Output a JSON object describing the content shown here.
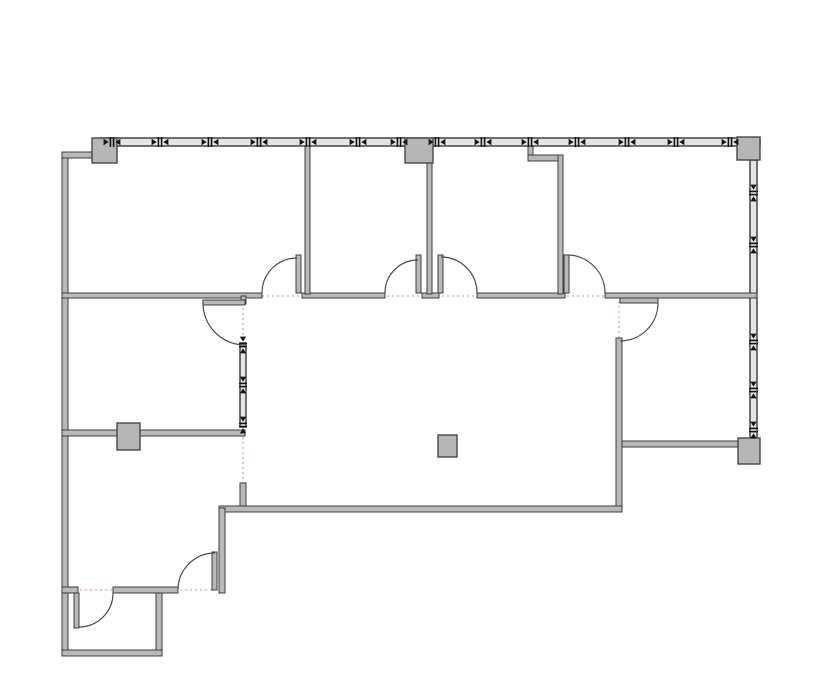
{
  "meta": {
    "title": "office-suite-floor-plan",
    "canvas_width": 835,
    "canvas_height": 678,
    "background": "#ffffff"
  },
  "style": {
    "wall_fill": "#b9b9b9",
    "wall_stroke": "#3d3d3d",
    "window_fill": "#e4e4e4",
    "window_stroke": "#383838",
    "column_fill": "#b6b6b6",
    "column_stroke": "#474747",
    "door_arc_color": "#4a4a4a",
    "opening_dot_color": "#dcc6d8",
    "mullion_color": "#161616"
  },
  "plan": {
    "openings": [
      {
        "name": "opening-line-corridor",
        "x1": 62,
        "y1": 296,
        "x2": 757,
        "y2": 296
      },
      {
        "name": "opening-line-lobby-west-door",
        "x1": 243,
        "y1": 298,
        "x2": 243,
        "y2": 345
      },
      {
        "name": "opening-line-lobby-southwest",
        "x1": 243,
        "y1": 427,
        "x2": 243,
        "y2": 483
      },
      {
        "name": "opening-line-southeast-room-door",
        "x1": 619,
        "y1": 296,
        "x2": 619,
        "y2": 340
      },
      {
        "name": "opening-line-southwest-rooms",
        "x1": 70,
        "y1": 590,
        "x2": 215,
        "y2": 590
      }
    ],
    "window_walls": [
      {
        "name": "north-window-wall",
        "x": 100,
        "y": 138,
        "w": 660,
        "h": 8,
        "orient": "h",
        "mullions": [
          112,
          160,
          210,
          259,
          308,
          358,
          399,
          437,
          483,
          530,
          577,
          627,
          676,
          730
        ]
      },
      {
        "name": "east-window-wall",
        "x": 750,
        "y": 160,
        "w": 7,
        "h": 278,
        "orient": "v",
        "mullions": [
          193,
          245,
          342,
          390,
          430
        ]
      },
      {
        "name": "lobby-glazed-partition",
        "x": 240,
        "y": 343,
        "w": 6,
        "h": 84,
        "orient": "v",
        "mullions": [
          345,
          385,
          425
        ]
      }
    ],
    "walls": [
      {
        "name": "west-exterior-wall",
        "x": 62,
        "y": 152,
        "w": 6,
        "h": 504
      },
      {
        "name": "northwest-wall-stub",
        "x": 62,
        "y": 152,
        "w": 30,
        "h": 6
      },
      {
        "name": "corridor-wall-seg-1",
        "x": 62,
        "y": 293,
        "w": 200,
        "h": 5
      },
      {
        "name": "corridor-wall-seg-2",
        "x": 302,
        "y": 293,
        "w": 83,
        "h": 5
      },
      {
        "name": "corridor-wall-seg-3",
        "x": 422,
        "y": 293,
        "w": 17,
        "h": 5
      },
      {
        "name": "corridor-wall-seg-4",
        "x": 477,
        "y": 293,
        "w": 88,
        "h": 5
      },
      {
        "name": "corridor-wall-seg-5",
        "x": 605,
        "y": 293,
        "w": 152,
        "h": 5
      },
      {
        "name": "divider-office1-office2",
        "x": 305,
        "y": 146,
        "w": 5,
        "h": 148
      },
      {
        "name": "divider-office2-office3",
        "x": 427,
        "y": 158,
        "w": 5,
        "h": 136
      },
      {
        "name": "office3-jog-stub",
        "x": 528,
        "y": 146,
        "w": 5,
        "h": 12
      },
      {
        "name": "office3-jog-wall",
        "x": 528,
        "y": 155,
        "w": 35,
        "h": 6
      },
      {
        "name": "divider-office3-office4",
        "x": 558,
        "y": 155,
        "w": 5,
        "h": 139
      },
      {
        "name": "lobby-east-wall",
        "x": 616,
        "y": 338,
        "w": 6,
        "h": 170
      },
      {
        "name": "lobby-west-wall-lower",
        "x": 240,
        "y": 483,
        "w": 6,
        "h": 25
      },
      {
        "name": "west-midroom-south-wall",
        "x": 62,
        "y": 430,
        "w": 183,
        "h": 6
      },
      {
        "name": "lobby-south-wall",
        "x": 219,
        "y": 506,
        "w": 403,
        "h": 6
      },
      {
        "name": "southeast-room-south-wall",
        "x": 622,
        "y": 441,
        "w": 120,
        "h": 6
      },
      {
        "name": "southwest-room-east-wall",
        "x": 219,
        "y": 508,
        "w": 6,
        "h": 85
      },
      {
        "name": "southwest-wall-stub",
        "x": 62,
        "y": 587,
        "w": 16,
        "h": 6
      },
      {
        "name": "southwest-room-south-wall-seg",
        "x": 113,
        "y": 587,
        "w": 65,
        "h": 6
      },
      {
        "name": "entry-room-east-wall",
        "x": 156,
        "y": 593,
        "w": 6,
        "h": 57
      },
      {
        "name": "entry-room-south-wall",
        "x": 62,
        "y": 650,
        "w": 100,
        "h": 6
      },
      {
        "name": "lobby-west-door-jamb",
        "x": 241,
        "y": 296,
        "w": 5,
        "h": 8
      }
    ],
    "door_leaves": [
      {
        "name": "office1-door-leaf",
        "x": 296,
        "y": 255,
        "w": 5,
        "h": 38
      },
      {
        "name": "office2-door-leaf",
        "x": 416,
        "y": 255,
        "w": 5,
        "h": 38
      },
      {
        "name": "office3-door-leaf",
        "x": 438,
        "y": 255,
        "w": 5,
        "h": 38
      },
      {
        "name": "office4-door-leaf",
        "x": 564,
        "y": 255,
        "w": 5,
        "h": 38
      },
      {
        "name": "west-midroom-door-leaf",
        "x": 203,
        "y": 300,
        "w": 42,
        "h": 5
      },
      {
        "name": "southeast-room-door-leaf",
        "x": 620,
        "y": 298,
        "w": 38,
        "h": 5
      },
      {
        "name": "southwest-room-door-leaf",
        "x": 212,
        "y": 552,
        "w": 5,
        "h": 38
      },
      {
        "name": "entry-room-door-leaf",
        "x": 74,
        "y": 593,
        "w": 5,
        "h": 35
      }
    ],
    "door_arcs": [
      {
        "name": "office1-door-swing",
        "sx": 262,
        "sy": 293,
        "r": 35,
        "ex": 297,
        "ey": 258,
        "sweep": 1
      },
      {
        "name": "office2-door-swing",
        "sx": 385,
        "sy": 293,
        "r": 33,
        "ex": 418,
        "ey": 260,
        "sweep": 1
      },
      {
        "name": "office3-door-swing",
        "sx": 441,
        "sy": 257,
        "r": 36,
        "ex": 477,
        "ey": 293,
        "sweep": 1
      },
      {
        "name": "office4-door-swing",
        "sx": 567,
        "sy": 255,
        "r": 38,
        "ex": 605,
        "ey": 293,
        "sweep": 1
      },
      {
        "name": "west-midroom-door-swing",
        "sx": 203,
        "sy": 303,
        "r": 42,
        "ex": 245,
        "ey": 345,
        "sweep": 0
      },
      {
        "name": "southeast-room-door-swing",
        "sx": 658,
        "sy": 303,
        "r": 38,
        "ex": 620,
        "ey": 341,
        "sweep": 1
      },
      {
        "name": "southwest-room-door-swing",
        "sx": 178,
        "sy": 590,
        "r": 37,
        "ex": 215,
        "ey": 553,
        "sweep": 1
      },
      {
        "name": "entry-room-door-swing",
        "sx": 113,
        "sy": 593,
        "r": 34,
        "ex": 79,
        "ey": 627,
        "sweep": 1
      }
    ],
    "columns": [
      {
        "name": "column-northwest",
        "x": 92,
        "y": 138,
        "w": 25,
        "h": 25
      },
      {
        "name": "column-north-middle",
        "x": 405,
        "y": 138,
        "w": 28,
        "h": 25
      },
      {
        "name": "column-northeast",
        "x": 737,
        "y": 137,
        "w": 23,
        "h": 23
      },
      {
        "name": "column-east-south",
        "x": 738,
        "y": 438,
        "w": 22,
        "h": 26
      },
      {
        "name": "column-west-middle",
        "x": 117,
        "y": 423,
        "w": 23,
        "h": 27
      },
      {
        "name": "column-lobby-center",
        "x": 438,
        "y": 435,
        "w": 19,
        "h": 22
      }
    ]
  }
}
